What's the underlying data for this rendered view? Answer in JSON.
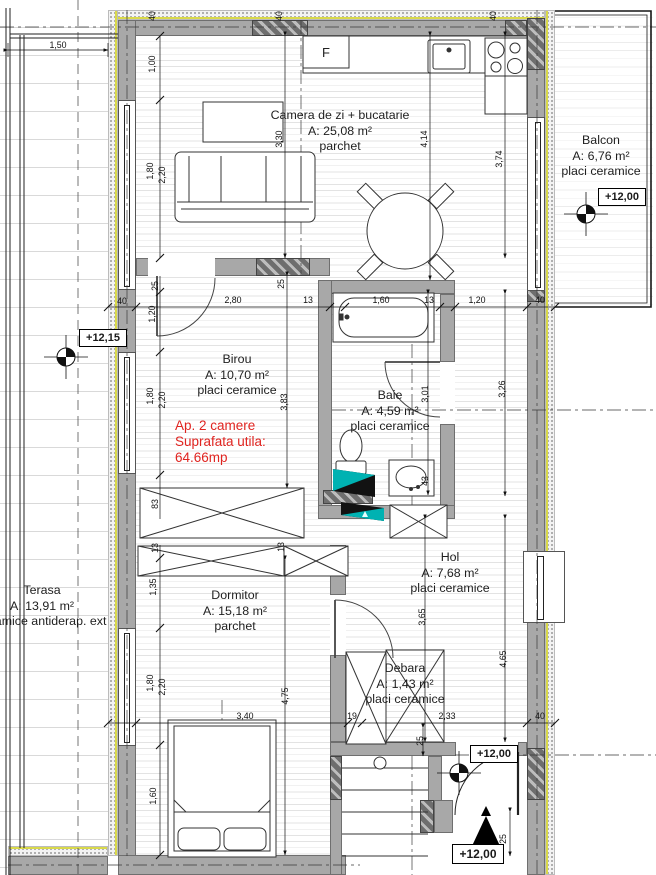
{
  "rooms": {
    "living": {
      "name": "Camera de zi + bucatarie",
      "area": "A: 25,08 m²",
      "floor": "parchet"
    },
    "balcony": {
      "name": "Balcon",
      "area": "A: 6,76 m²",
      "floor": "placi ceramice"
    },
    "office": {
      "name": "Birou",
      "area": "A: 10,70 m²",
      "floor": "placi ceramice"
    },
    "bath": {
      "name": "Baie",
      "area": "A: 4,59 m²",
      "floor": "placi ceramice"
    },
    "terrace": {
      "name": "Terasa",
      "area": "A: 13,91 m²",
      "floor": "ceramice antiderap. ext"
    },
    "hall": {
      "name": "Hol",
      "area": "A: 7,68 m²",
      "floor": "placi ceramice"
    },
    "bedroom": {
      "name": "Dormitor",
      "area": "A: 15,18 m²",
      "floor": "parchet"
    },
    "storage": {
      "name": "Debara",
      "area": "A: 1,43 m²",
      "floor": "placi ceramice"
    }
  },
  "note": {
    "line1": "Ap. 2 camere",
    "line2": "Suprafata utila:",
    "line3": "64.66mp"
  },
  "levels": {
    "terrace": "+12,15",
    "balcony": "+12,00",
    "entry": "+12,00",
    "stair": "+12,00"
  },
  "appliances": {
    "fridge": "F"
  },
  "dims": {
    "d150": "1,50",
    "d40": "40",
    "d100": "1,00",
    "d180": "1,80",
    "d220": "2,20",
    "d330": "3,30",
    "d414": "4,14",
    "d374": "3,74",
    "d280": "2,80",
    "d13": "13",
    "d160": "1,60",
    "d120": "1,20",
    "d25": "25",
    "d383": "3,83",
    "d301": "3,01",
    "d326": "3,26",
    "d83": "83",
    "d43": "43",
    "d135": "1,35",
    "d475": "4,75",
    "d340": "3,40",
    "d365": "3,65",
    "d465": "4,65",
    "d19": "19",
    "d233": "2,33"
  },
  "colors": {
    "wall": "#a8a8a8",
    "note_red": "#e02420",
    "shaft_teal": "#00b2b2",
    "insulation": "#d9d94a"
  }
}
